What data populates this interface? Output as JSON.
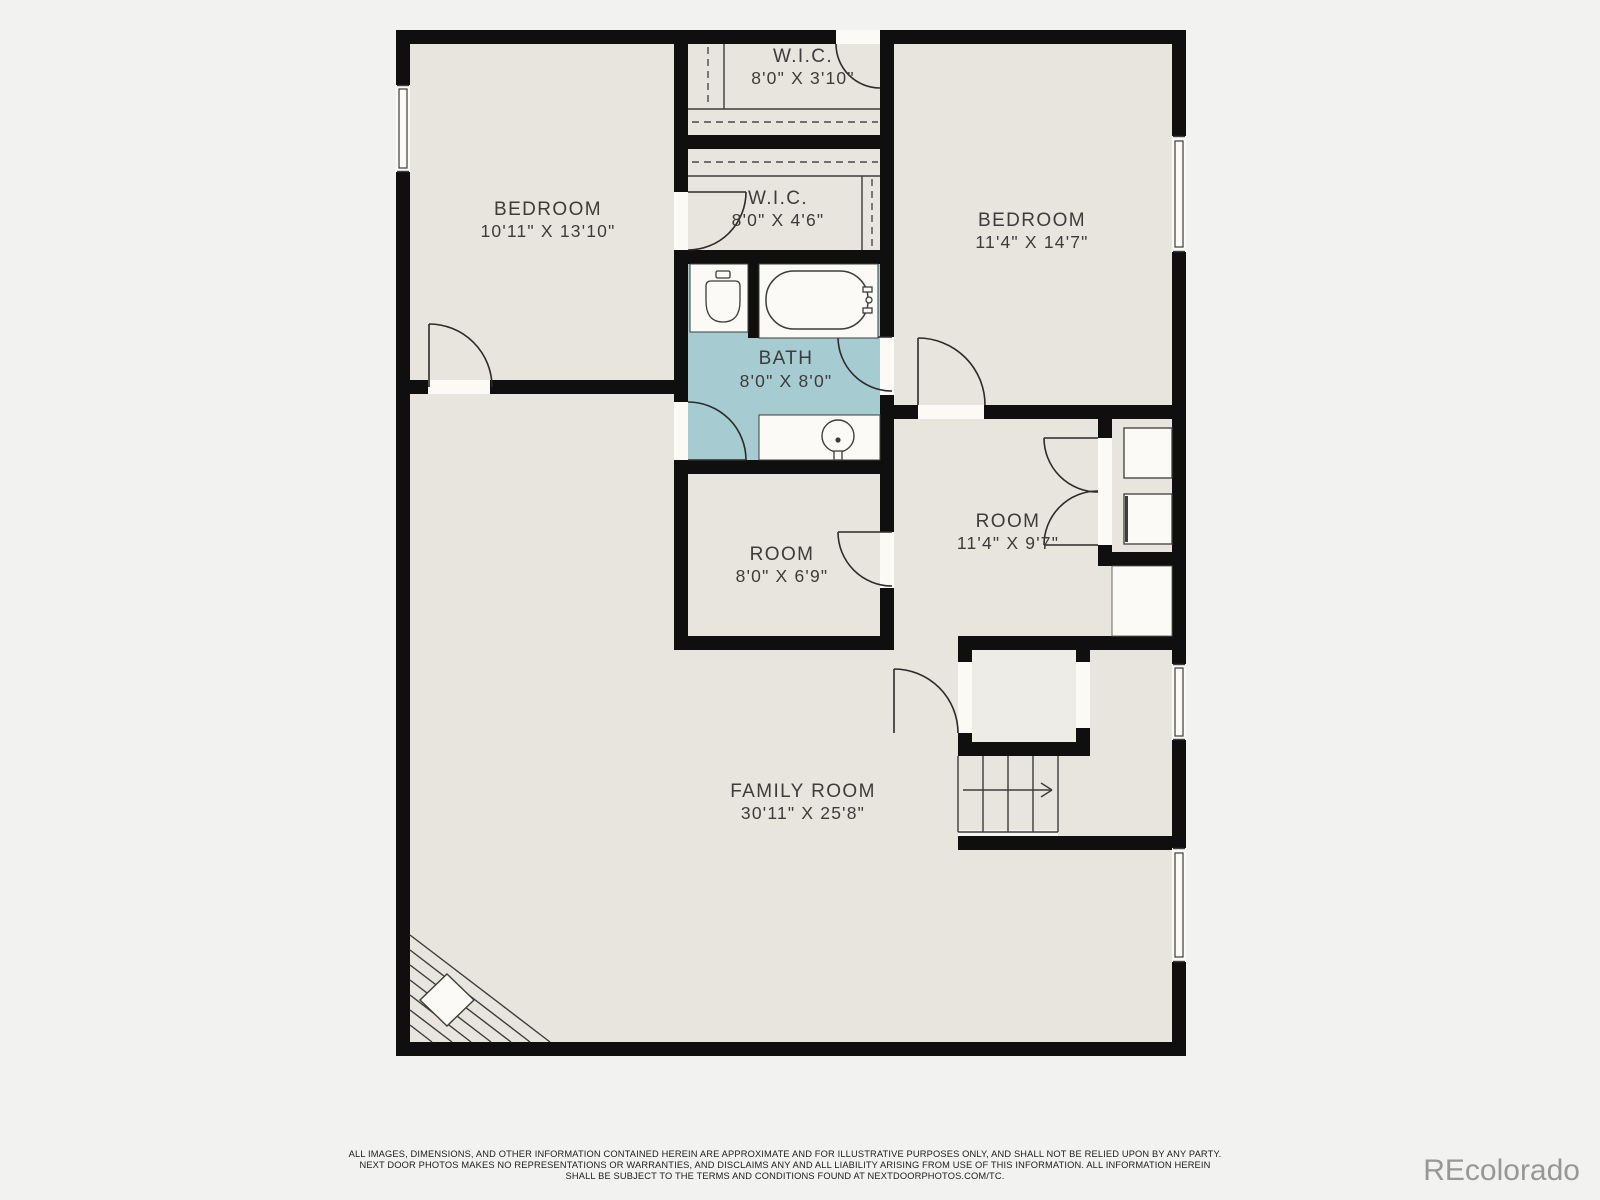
{
  "plan": {
    "rooms": [
      {
        "id": "wic-top",
        "name": "W.I.C.",
        "dims": "8'0\" X 3'10\""
      },
      {
        "id": "wic-mid",
        "name": "W.I.C.",
        "dims": "8'0\" X 4'6\""
      },
      {
        "id": "bath",
        "name": "BATH",
        "dims": "8'0\" X 8'0\""
      },
      {
        "id": "bedroom-left",
        "name": "BEDROOM",
        "dims": "10'11\" X 13'10\""
      },
      {
        "id": "bedroom-right",
        "name": "BEDROOM",
        "dims": "11'4\" X 14'7\""
      },
      {
        "id": "room-middle",
        "name": "ROOM",
        "dims": "8'0\" X 6'9\""
      },
      {
        "id": "room-right",
        "name": "ROOM",
        "dims": "11'4\" X 9'7\""
      },
      {
        "id": "family-room",
        "name": "FAMILY ROOM",
        "dims": "30'11\" X 25'8\""
      }
    ],
    "colors": {
      "page": "#f2f2f0",
      "floor": "#e8e5de",
      "bath_floor": "#a6cbd1",
      "wall": "#0f0f0f",
      "fixture_white": "#fbfaf7",
      "label_text": "#3c3c3a",
      "watermark_gray": "#979797"
    }
  },
  "footer": {
    "line1": "ALL IMAGES, DIMENSIONS, AND OTHER INFORMATION CONTAINED HEREIN ARE APPROXIMATE AND FOR ILLUSTRATIVE PURPOSES ONLY, AND SHALL NOT BE RELIED UPON BY ANY PARTY.",
    "line2": "NEXT DOOR PHOTOS MAKES NO REPRESENTATIONS OR WARRANTIES, AND DISCLAIMS ANY AND ALL LIABILITY ARISING FROM USE OF THIS INFORMATION. ALL INFORMATION HEREIN",
    "line3": "SHALL BE SUBJECT TO THE TERMS AND CONDITIONS FOUND AT NEXTDOORPHOTOS.COM/TC."
  },
  "watermark": {
    "text": "REcolorado"
  }
}
